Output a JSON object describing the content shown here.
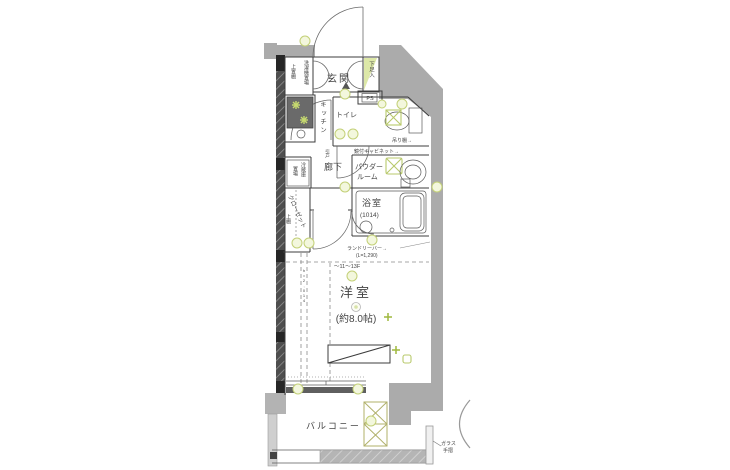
{
  "labels": {
    "genkan": "玄関",
    "shoe_box": "下足入",
    "washer": "洗濯機置場",
    "washer_shelf": "上置棚",
    "ps": "PS",
    "kitchen": "キッチン",
    "toilet": "トイレ",
    "toilet_shelf": "吊り棚→",
    "mirror_cabinet": "鏡付キャビネット→",
    "hallway": "廊下",
    "hall_door": "引戸",
    "fridge_1": "冷蔵庫",
    "fridge_2": "置場",
    "powder_1": "パウダー",
    "powder_2": "ルーム",
    "closet": "クローゼット",
    "closet_shelf": "上棚",
    "bath": "浴室",
    "bath_size": "(1014)",
    "laundry_bar": "ランドリーバー→",
    "laundry_len": "(L=1,290)",
    "floors_note": "〜11〜13F",
    "main_room": "洋室",
    "main_room_size": "(約8.0帖)",
    "beam_note": "h=2,014",
    "balcony": "バルコニー",
    "glass_1": "ガラス",
    "glass_2": "手摺"
  },
  "colors": {
    "wall_gray": "#ababab",
    "dark_wall": "#4e4e4e",
    "accent_green": "#b8c96b",
    "highlight_fill": "#f3f7dd",
    "line": "#3c3c3c"
  }
}
